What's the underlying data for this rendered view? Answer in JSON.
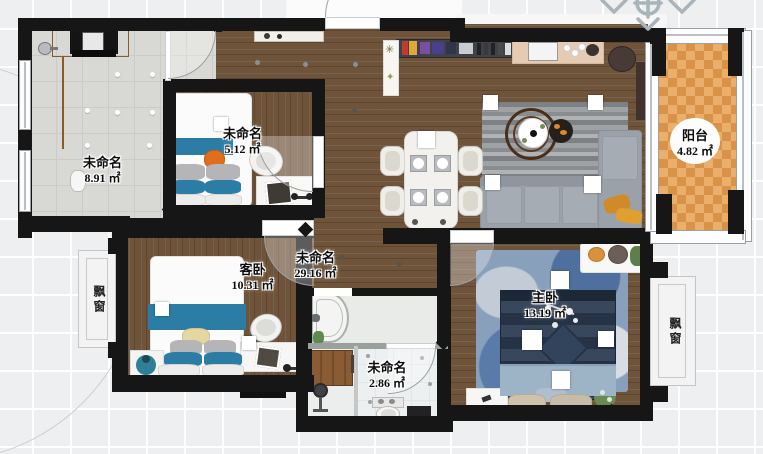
{
  "rooms": [
    {
      "key": "storage",
      "name": "未命名",
      "area": "8.91 ㎡"
    },
    {
      "key": "bedroom2",
      "name": "未命名",
      "area": "5.12 ㎡"
    },
    {
      "key": "living",
      "name": "未命名",
      "area": "29.16 ㎡"
    },
    {
      "key": "guest",
      "name": "客卧",
      "area": "10.31 ㎡"
    },
    {
      "key": "toilet",
      "name": "未命名",
      "area": "2.86 ㎡"
    },
    {
      "key": "master",
      "name": "主卧",
      "area": "13.19 ㎡"
    },
    {
      "key": "balcony",
      "name": "阳台",
      "area": "4.82 ㎡"
    }
  ],
  "bay_windows": {
    "left": "飘窗",
    "right": "飘窗"
  },
  "colors": {
    "wall": "#161616",
    "wood": "#6f543a",
    "accent_blue": "#2b7da6",
    "balcony_tile": "#d89349",
    "bed_navy": "#2c3c52",
    "sofa_gray": "#9aa1a9",
    "pillow_orange": "#d08a28",
    "canvas": "#edeff0"
  }
}
